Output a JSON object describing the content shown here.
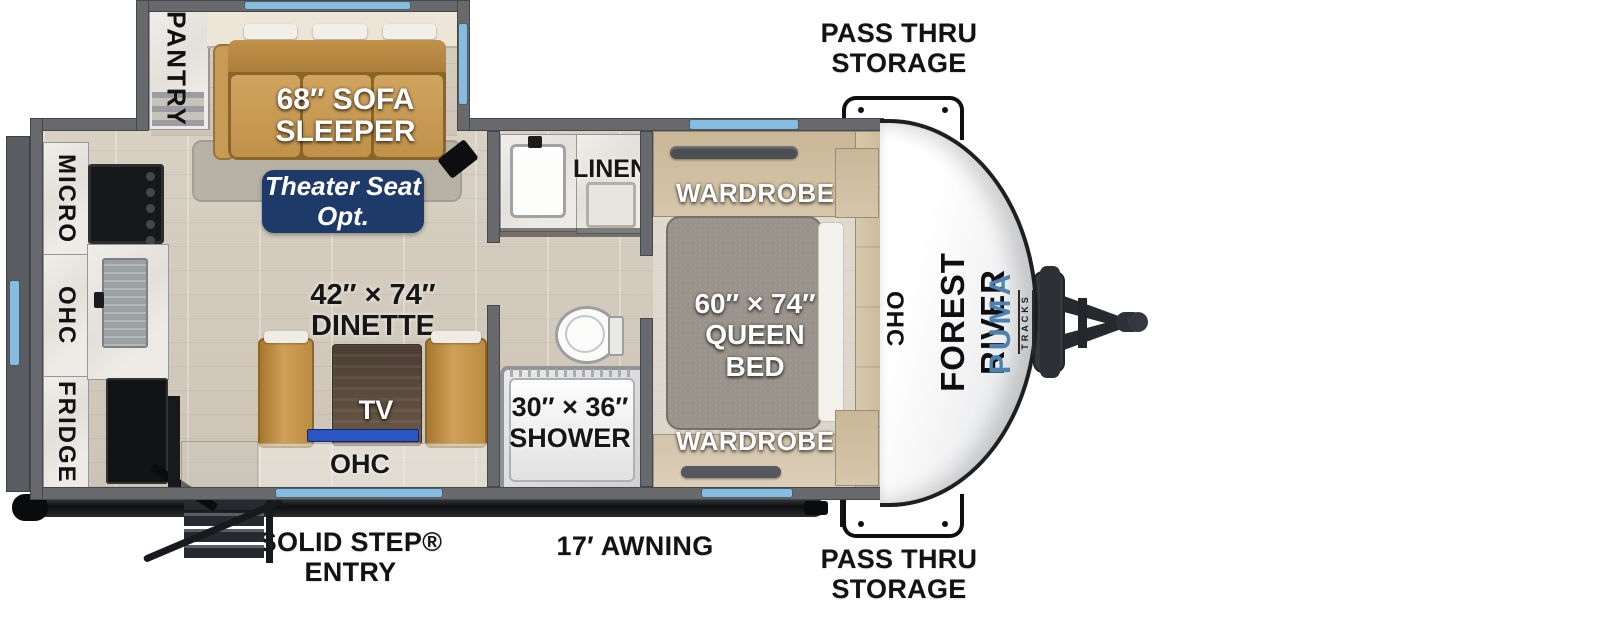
{
  "title": "Forest River Puma Tracks travel trailer floorplan",
  "colors": {
    "accent_blue": "#85bcdf",
    "badge_navy": "#1d3a69",
    "puma_blue": "#4d82b0",
    "tv_blue": "#2b55c5",
    "sofa_tan": "#c79b55",
    "wall_gray": "#67696d"
  },
  "annotations": {
    "pass_thru_top": {
      "line1": "PASS THRU",
      "line2": "STORAGE"
    },
    "pass_thru_bottom": {
      "line1": "PASS THRU",
      "line2": "STORAGE"
    },
    "solid_step": {
      "line1": "SOLID STEP®",
      "line2": "ENTRY"
    },
    "awning": "17′ AWNING"
  },
  "branding": {
    "manufacturer": "FOREST RIVER",
    "model": "PUMA",
    "series": "TRACKS"
  },
  "rooms": {
    "pantry": "PANTRY",
    "sofa": {
      "line1": "68″ SOFA",
      "line2": "SLEEPER"
    },
    "theater": {
      "line1": "Theater Seat",
      "line2": "Opt."
    },
    "dinette": {
      "line1": "42″ × 74″",
      "line2": "DINETTE"
    },
    "tv": "TV",
    "dinette_ohc": "OHC",
    "kitchen": {
      "micro": "MICRO",
      "ohc": "OHC",
      "fridge": "FRIDGE"
    },
    "bath": {
      "linen": "LINEN",
      "shower1": "30″ × 36″",
      "shower2": "SHOWER"
    },
    "bed": {
      "wardrobe_top": "WARDROBE",
      "wardrobe_bottom": "WARDROBE",
      "size1": "60″ × 74″",
      "size2": "QUEEN BED",
      "ohc": "OHC"
    }
  }
}
